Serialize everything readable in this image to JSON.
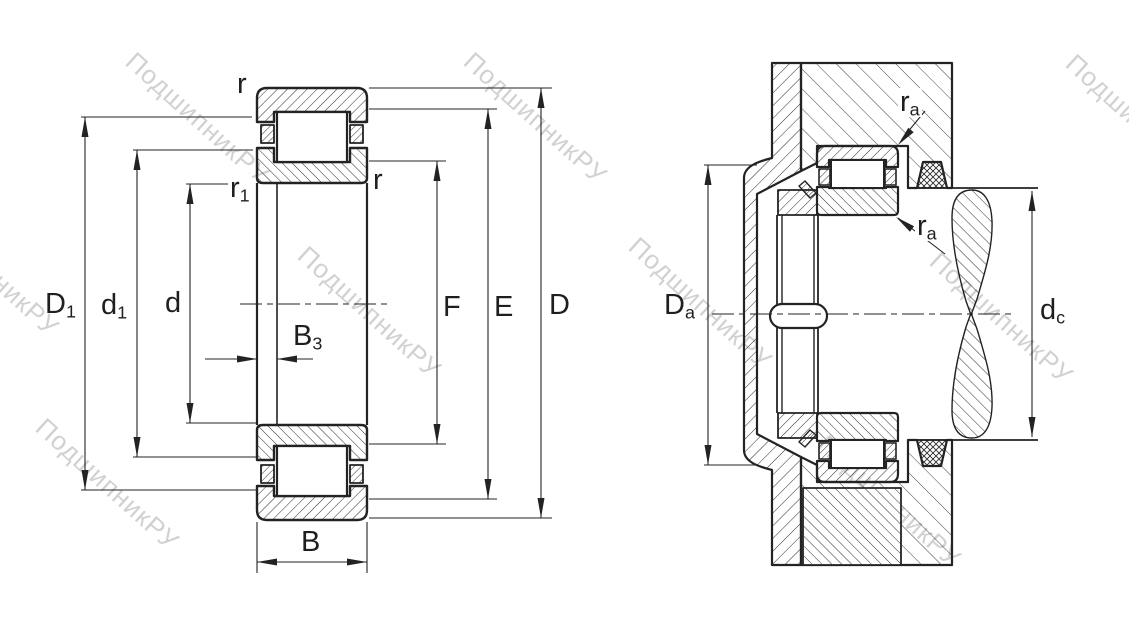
{
  "drawing": {
    "type": "bearing-technical-drawing",
    "views": {
      "left_view": "cylindrical roller bearing cross-section with boundary dimensions",
      "right_view": "bearing mounted in housing with shaft, abutment dimensions"
    },
    "left_labels": {
      "r_top": "r",
      "r_right": "r",
      "r1_base": "r",
      "r1_sub": "1",
      "D1_base": "D",
      "D1_sub": "1",
      "d1_base": "d",
      "d1_sub": "1",
      "d": "d",
      "B3_base": "B",
      "B3_sub": "3",
      "B": "B",
      "F": "F",
      "E": "E",
      "D": "D"
    },
    "right_labels": {
      "ra_top_base": "r",
      "ra_top_sub": "a",
      "ra_bot_base": "r",
      "ra_bot_sub": "a",
      "Da_base": "D",
      "Da_sub": "a",
      "dc_base": "d",
      "dc_sub": "c"
    }
  },
  "watermark": {
    "text": "ПодшипникРУ",
    "color": "#b5b5b5"
  },
  "colors": {
    "line": "#232323",
    "background": "#ffffff",
    "watermark": "#b5b5b5"
  }
}
